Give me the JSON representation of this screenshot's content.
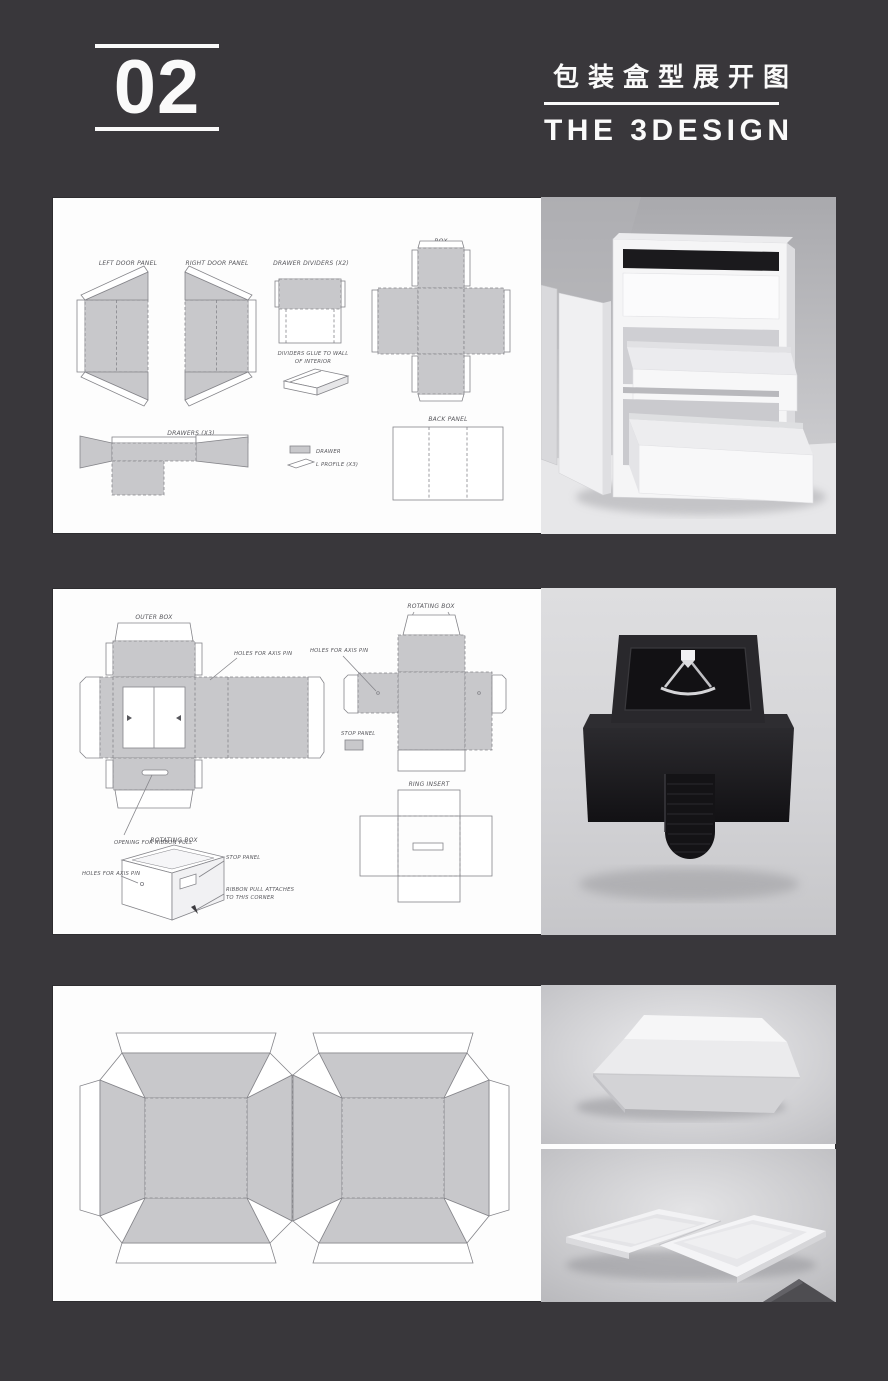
{
  "page": {
    "background": "#39373b",
    "panel_color": "#fdfdfd"
  },
  "header": {
    "section_number": "02",
    "title_zh": "包装盒型展开图",
    "title_en": "THE 3DESIGN"
  },
  "panel1": {
    "labels": {
      "left_door": "LEFT DOOR PANEL",
      "right_door": "RIGHT DOOR PANEL",
      "drawer_dividers": "DRAWER DIVIDERS (X2)",
      "divider_note_1": "DIVIDERS GLUE TO WALL",
      "divider_note_2": "OF INTERIOR",
      "box": "BOX",
      "drawers": "DRAWERS (X3)",
      "legend_drawer": "DRAWER",
      "legend_profile": "L PROFILE (X3)",
      "back_panel": "BACK PANEL"
    }
  },
  "panel2": {
    "labels": {
      "outer_box": "OUTER BOX",
      "holes_axis_1": "HOLES FOR AXIS PIN",
      "rotating_box": "ROTATING BOX",
      "holes_axis_2": "HOLES FOR AXIS PIN",
      "stop_panel": "STOP PANEL",
      "ring_insert": "RING INSERT",
      "opening_ribbon": "OPENING FOR RIBBON PULL",
      "sketch_title": "ROTATING BOX",
      "sketch_holes": "HOLES FOR AXIS PIN",
      "sketch_stop": "STOP PANEL",
      "sketch_ribbon_1": "RIBBON PULL ATTACHES",
      "sketch_ribbon_2": "TO THIS CORNER"
    }
  },
  "panel3": {
    "labels": {}
  }
}
